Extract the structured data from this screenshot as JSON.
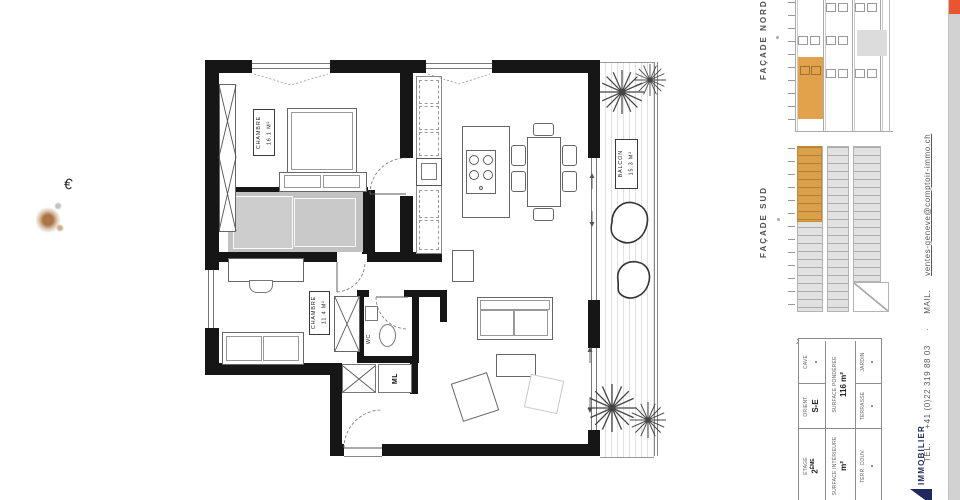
{
  "plan": {
    "chambre1": {
      "name": "CHAMBRE",
      "area": "16.1 M²"
    },
    "chambre2": {
      "name": "CHAMBRE",
      "area": "11.4 M²"
    },
    "balcon": {
      "name": "BALCON",
      "area": "15.3 M²"
    },
    "wc": "WC",
    "ml": "ML"
  },
  "facades": {
    "nord": "FAÇADE NORD",
    "sud": "FAÇADE SUD"
  },
  "info_table": {
    "etage": {
      "label": "ÉTAGE",
      "num": "2",
      "sup": "ÈME"
    },
    "orient": {
      "label": "ORIENT.",
      "value": "S-E"
    },
    "cave": {
      "label": "CAVE",
      "value": "-"
    },
    "surface_interieure": {
      "label": "SURFACE INTÉRIEURE",
      "value": "m²"
    },
    "surface_ponderee": {
      "label": "SURFACE PONDÉRÉE",
      "value": "116 m²"
    },
    "terr_couv": {
      "label": "TERR. COUV.",
      "value": "-"
    },
    "terrasse": {
      "label": "TERRASSE",
      "value": "-"
    },
    "jardin": {
      "label": "JARDIN",
      "value": "-"
    }
  },
  "contact": {
    "tel_label": "TEL.",
    "tel_number": "+41 (0)22 319 88 03",
    "separator": "·",
    "mail_label": "MAIL.",
    "email": "ventes-geneve@comptoir-immo.ch"
  },
  "logo": {
    "text": "IMMOBILIER"
  },
  "artifacts": {
    "euro_mark": "€"
  },
  "misc": {
    "chevron": "›"
  },
  "colors": {
    "unit_highlight": "#E2A24C",
    "accent_orange": "#E8552E",
    "facade_gray": "#E1E1E1",
    "strip_gray": "#D2D2D2",
    "logo_navy": "#1C2B5B"
  }
}
